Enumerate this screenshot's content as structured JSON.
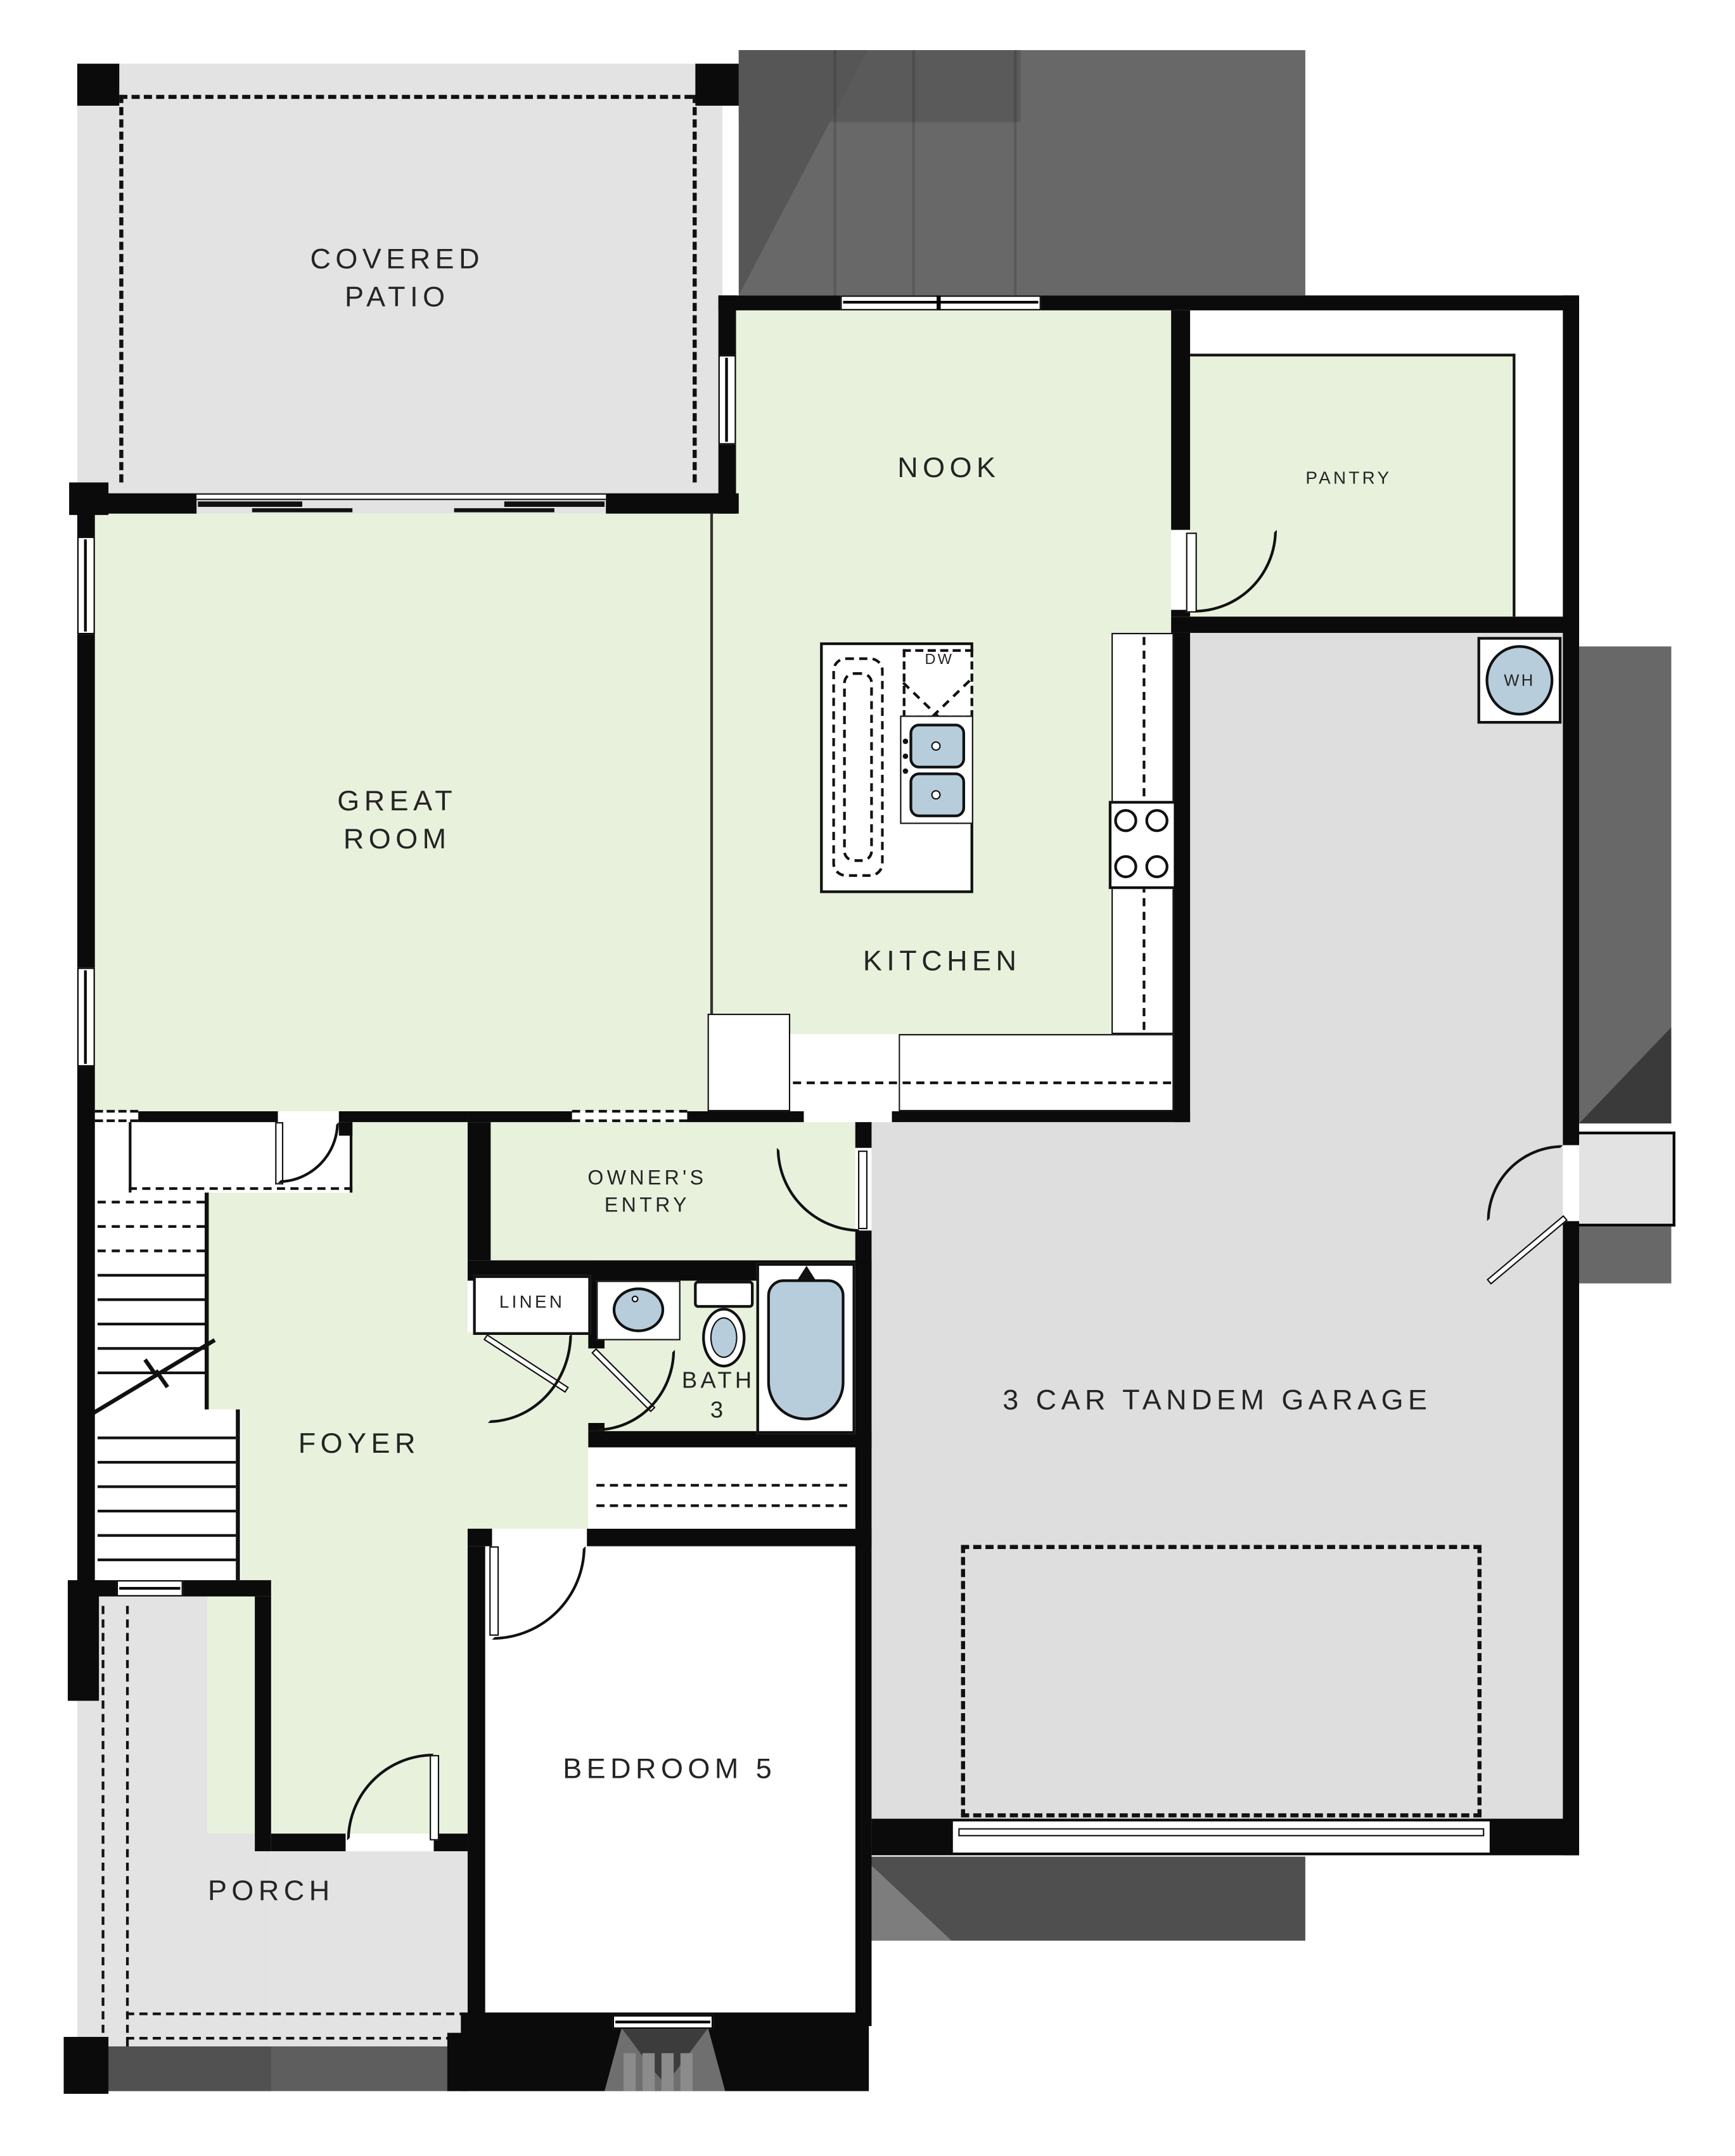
{
  "plan": {
    "type": "residential-floor-plan",
    "rooms": {
      "covered_patio": "COVERED\nPATIO",
      "nook": "NOOK",
      "pantry": "PANTRY",
      "great_room": "GREAT\nROOM",
      "kitchen": "KITCHEN",
      "owners_entry": "OWNER'S\nENTRY",
      "linen": "LINEN",
      "bath": "BATH\n3",
      "foyer": "FOYER",
      "garage": "3 CAR TANDEM GARAGE",
      "bedroom5": "BEDROOM 5",
      "porch": "PORCH"
    },
    "appliances": {
      "dishwasher": "DW",
      "water_heater": "WH"
    },
    "colors": {
      "room_green": "#e8f1dc",
      "hardscape_gray": "#e3e3e4",
      "garage_gray": "#dedede",
      "roof_dark": "#686868",
      "wall_black": "#0b0b0b",
      "fixture_blue": "#b7cddc"
    }
  }
}
